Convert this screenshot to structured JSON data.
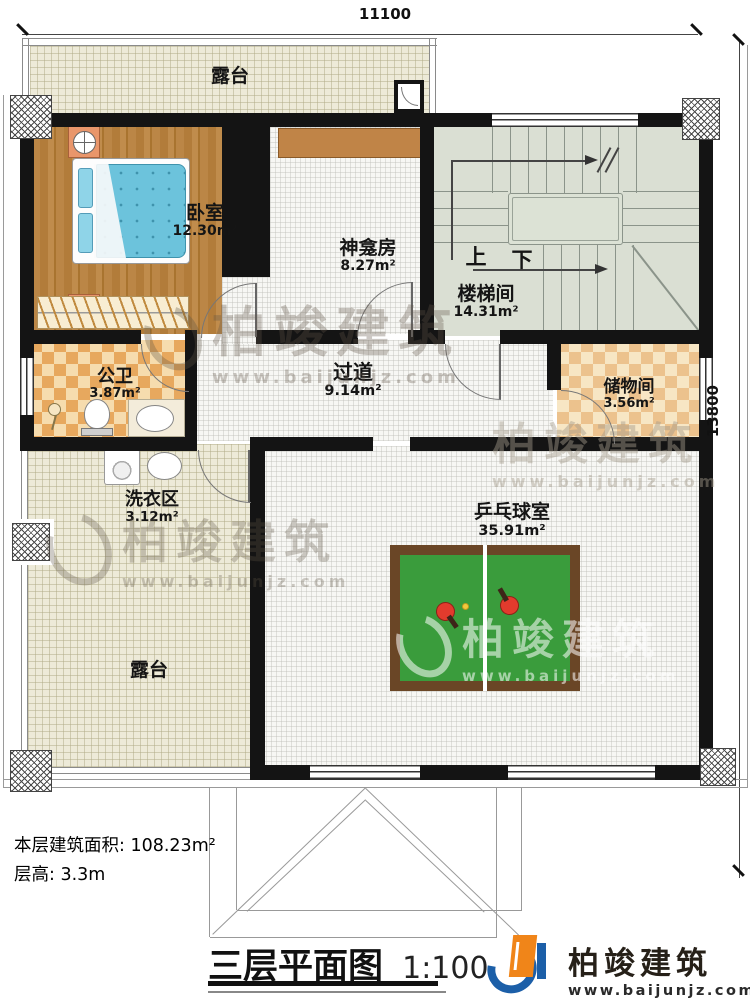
{
  "dimensions": {
    "top": "11100",
    "right": "13800"
  },
  "rooms": {
    "terrace_top": {
      "name": "露台"
    },
    "bedroom": {
      "name": "卧室",
      "area": "12.30m²"
    },
    "shrine": {
      "name": "神龛房",
      "area": "8.27m²"
    },
    "stair": {
      "name": "楼梯间",
      "area": "14.31m²",
      "up": "上",
      "down": "下"
    },
    "bathroom": {
      "name": "公卫",
      "area": "3.87m²"
    },
    "corridor": {
      "name": "过道",
      "area": "9.14m²"
    },
    "storage": {
      "name": "储物间",
      "area": "3.56m²"
    },
    "laundry": {
      "name": "洗衣区",
      "area": "3.12m²"
    },
    "pingpong": {
      "name": "乒乓球室",
      "area": "35.91m²"
    },
    "terrace_bottom": {
      "name": "露台"
    }
  },
  "notes": {
    "floor_area": "本层建筑面积: 108.23m²",
    "floor_height": "层高: 3.3m"
  },
  "title": {
    "name": "三层平面图",
    "scale": "1:100"
  },
  "brand": {
    "name": "柏竣建筑",
    "site": "www.baijunjz.com"
  },
  "watermark": {
    "name": "柏竣建筑",
    "site": "www.baijunjz.com"
  },
  "colors": {
    "wall": "#141414",
    "terrace": "#edead8",
    "wood": "#b5803f",
    "checker_orange": "#e7a85e",
    "checker_tan": "#ecc28d",
    "stairs": "#dadfd3",
    "table_green": "#3a9c3c",
    "brand_blue": "#1c5fa8",
    "brand_orange": "#f08519"
  }
}
